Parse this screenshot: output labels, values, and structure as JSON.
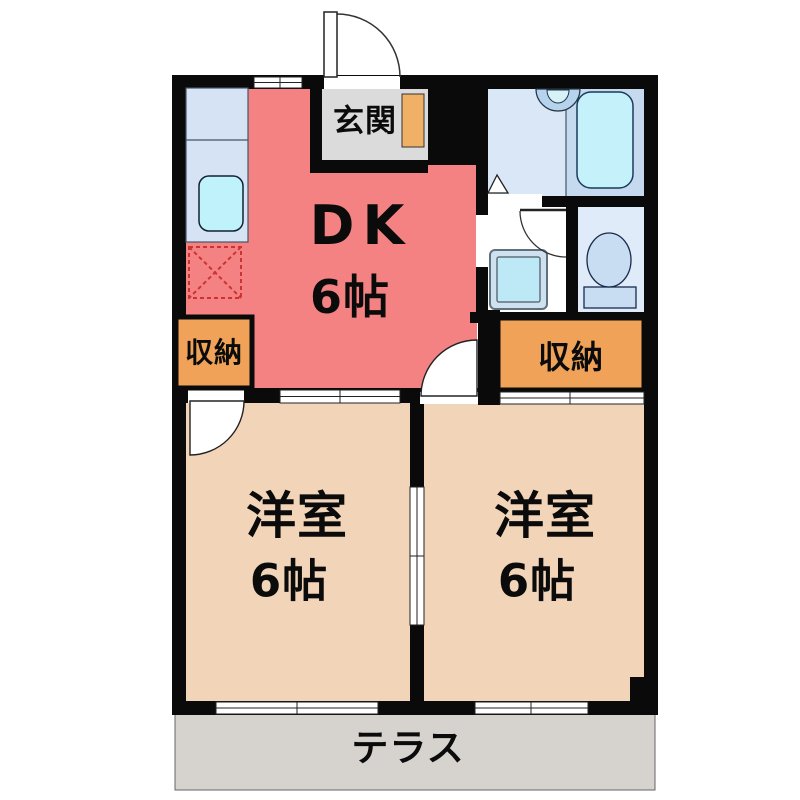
{
  "plan_title": "2DK apartment floor plan",
  "rooms": {
    "genkan": {
      "label": "玄関"
    },
    "dk": {
      "label": "DK",
      "size": "6帖"
    },
    "closet_left": {
      "label": "収納"
    },
    "closet_right": {
      "label": "収納"
    },
    "bedroom_left": {
      "label": "洋室",
      "size": "6帖"
    },
    "bedroom_right": {
      "label": "洋室",
      "size": "6帖"
    },
    "terrace": {
      "label": "テラス"
    }
  },
  "colors": {
    "wall": "#0a0a0a",
    "dk": "#f48282",
    "bedroom": "#f2d5b9",
    "closet": "#f0a358",
    "genkan": "#dbdbdb",
    "genkan_cabinet": "#f0b066",
    "terrace": "#d6d2ce",
    "bath": "#d9e7f6",
    "bath_right": "#c6daef",
    "tub": "#c5f1fa",
    "toilet_room": "#dfebf9",
    "fixture_blue": "#c8dcf2",
    "counter": "#d5e3f4",
    "sink": "#bff2fa",
    "washer": "#bce9f5",
    "fridge_dash": "#cc3333"
  }
}
